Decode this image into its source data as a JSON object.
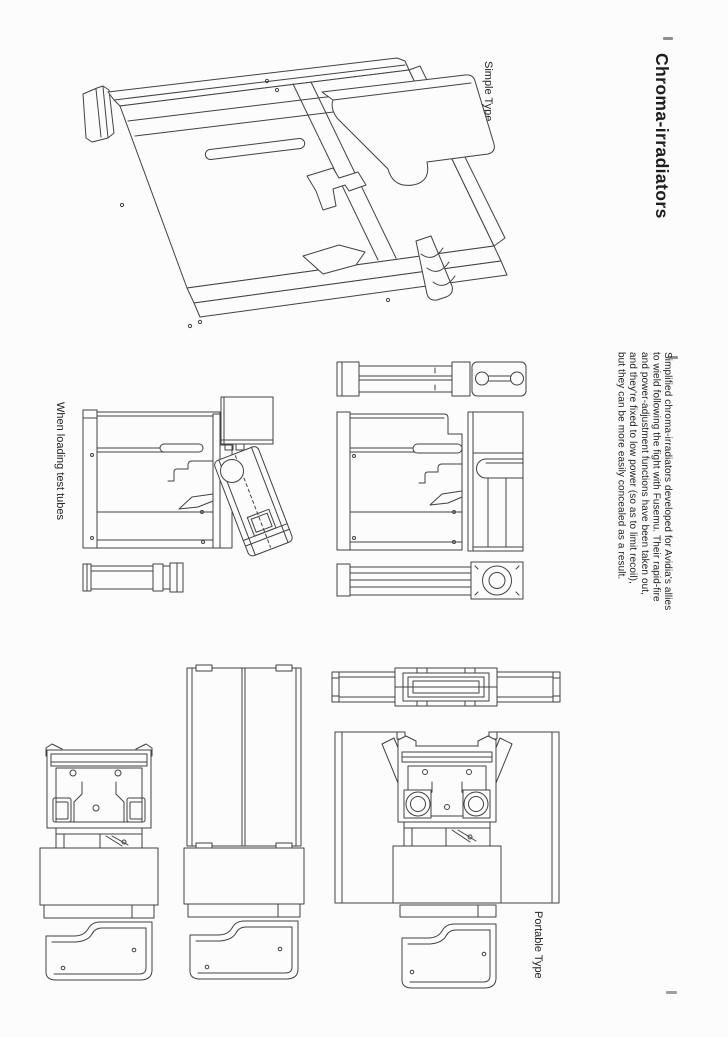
{
  "page": {
    "background": "#fcfcfc",
    "ink_color": "#424242",
    "text_color": "#1c1c1c"
  },
  "header": {
    "title": "Chroma-irradiators"
  },
  "description": {
    "lines": [
      "Simplified chroma-irradiators developed for Avidia's allies",
      "to wield following the fight with Fusemu. Their rapid-fire",
      "and power-adjustment functions have been taken out,",
      "and they're fixed to low power (so as to limit recoil),",
      "but they can be more easily concealed as a result."
    ]
  },
  "figures": {
    "simple_type": {
      "label": "Simple Type"
    },
    "test_tubes": {
      "label": "When loading test tubes"
    },
    "portable_type": {
      "label": "Portable Type"
    }
  }
}
